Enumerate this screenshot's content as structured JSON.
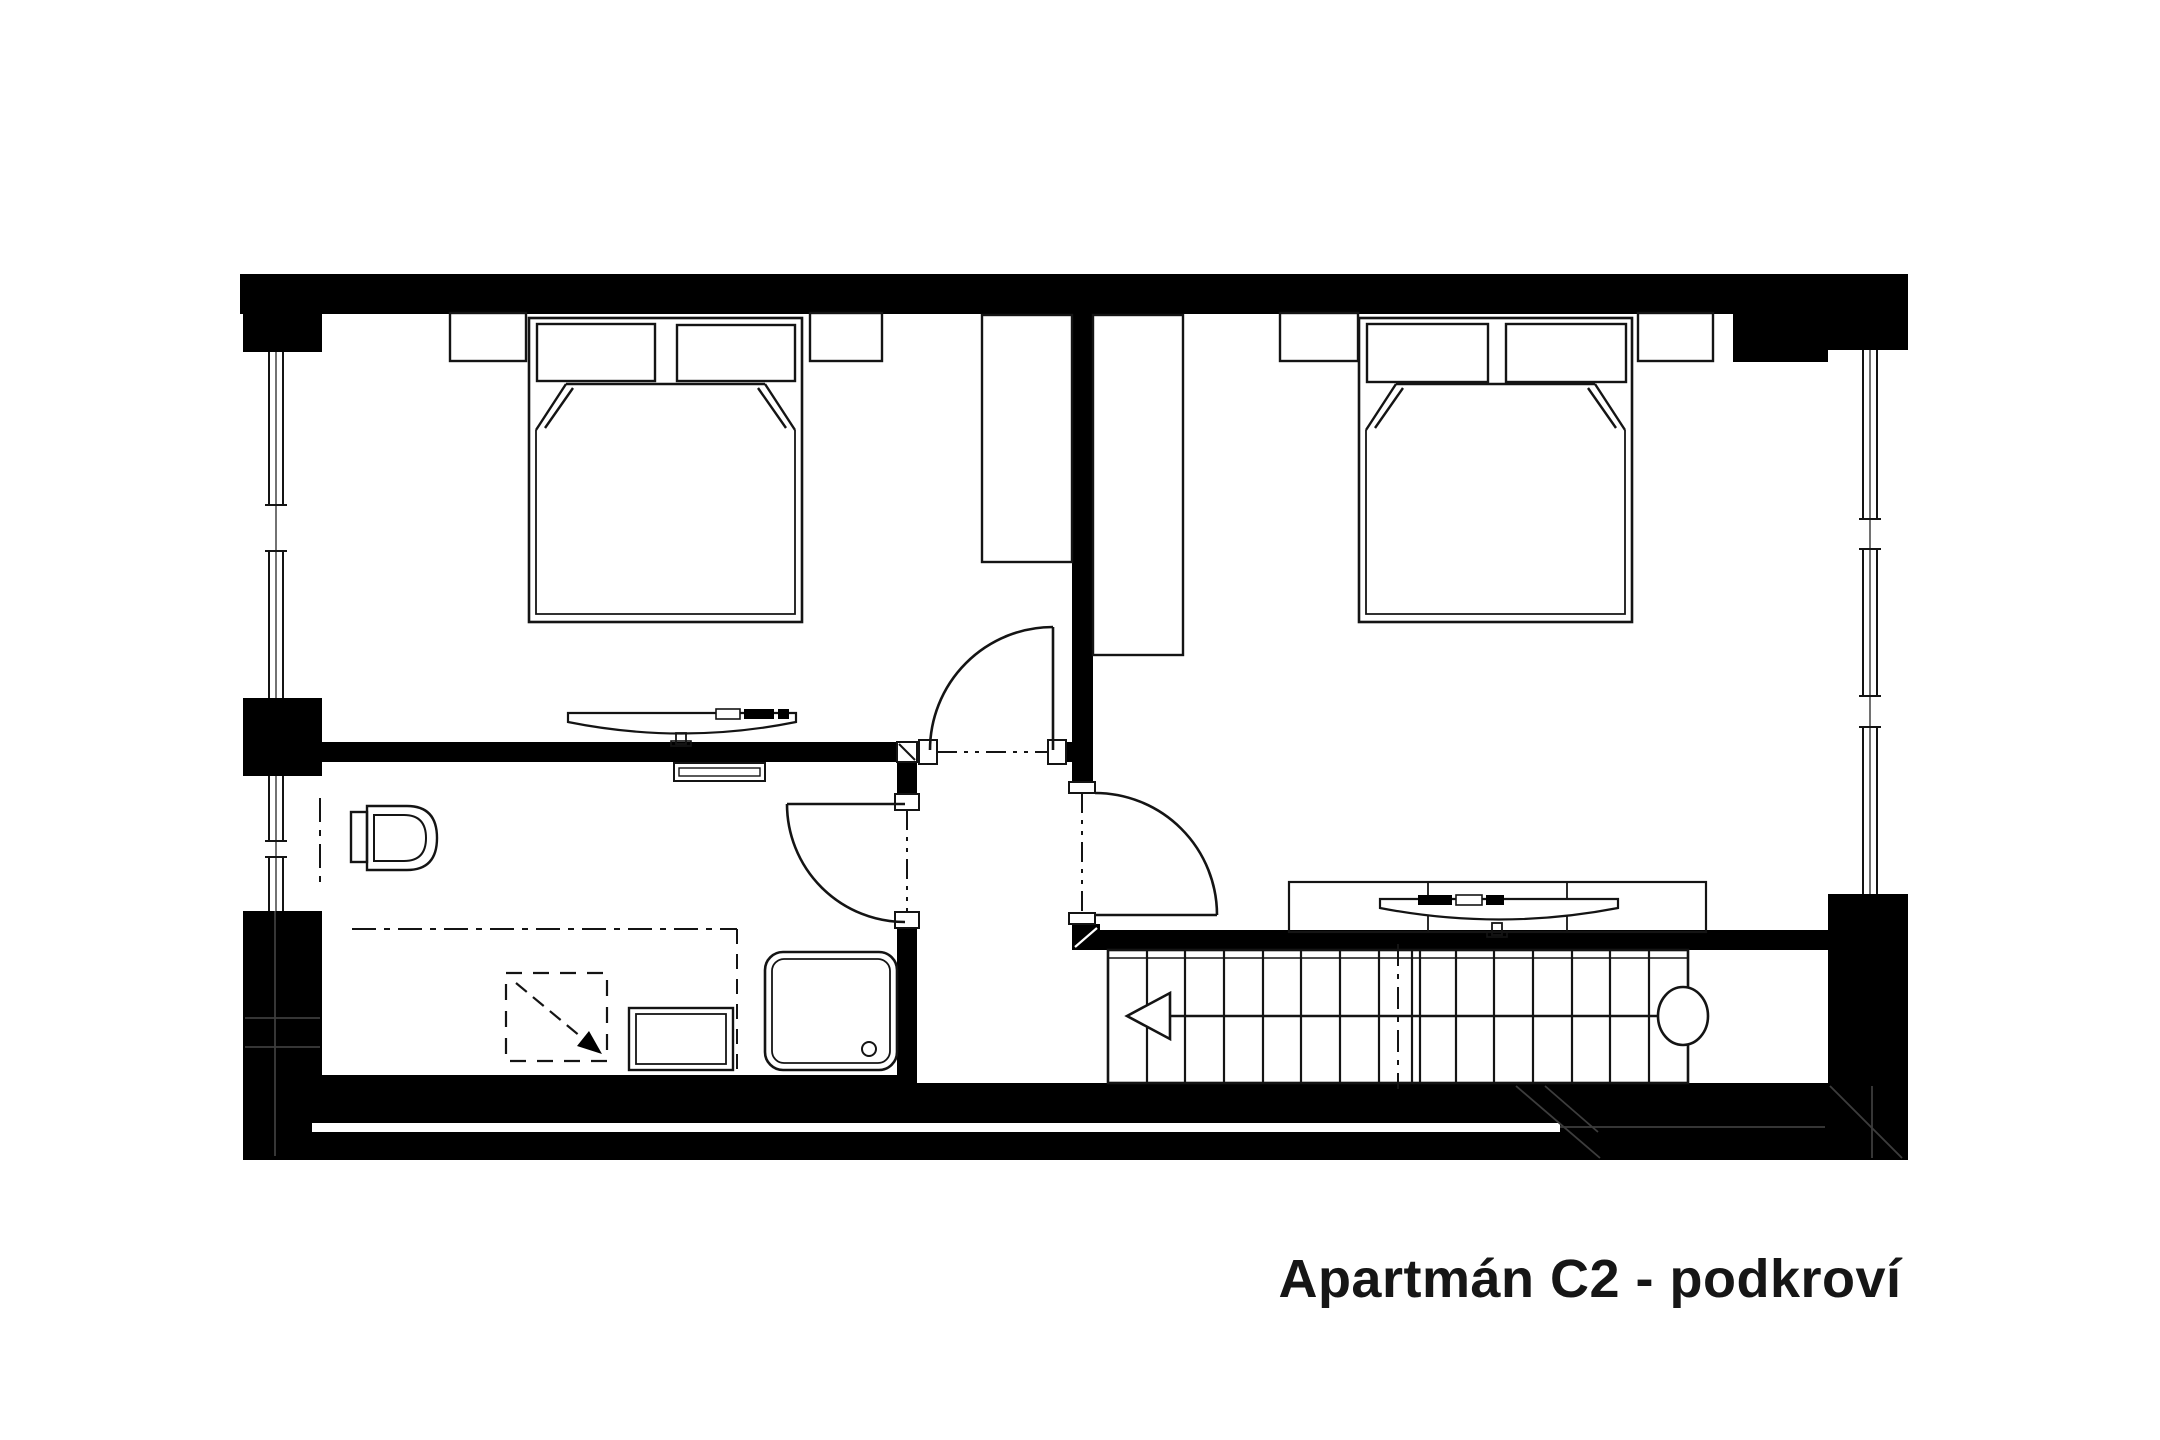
{
  "title": {
    "text": "Apartmán C2 - podkroví"
  },
  "colors": {
    "walls": "#000000",
    "lines": "#141414",
    "background": "#ffffff",
    "title": "#161616"
  },
  "plan": {
    "type": "apartment-attic-floorplan",
    "rooms": [
      {
        "name": "bedroom-left",
        "fixtures": [
          "double-bed",
          "two-pillows",
          "nightstand-left",
          "nightstand-right",
          "wardrobe",
          "desk-chair",
          "window-west",
          "door-to-hall"
        ]
      },
      {
        "name": "bedroom-right",
        "fixtures": [
          "double-bed",
          "two-pillows",
          "nightstand-left",
          "nightstand-right",
          "wardrobe",
          "desk-with-chair",
          "window-east",
          "door-to-hall"
        ]
      },
      {
        "name": "bathroom",
        "fixtures": [
          "wall-hung-toilet",
          "shower-tray-with-drain",
          "washing-machine",
          "radiator",
          "ceiling-height-dashline",
          "slope-arrow-square",
          "window-west",
          "door-to-hall"
        ]
      },
      {
        "name": "hall-landing",
        "fixtures": [
          "three-door-openings"
        ]
      },
      {
        "name": "staircase",
        "steps": 15,
        "direction_arrow": "left",
        "start_marker": "circle"
      }
    ]
  }
}
